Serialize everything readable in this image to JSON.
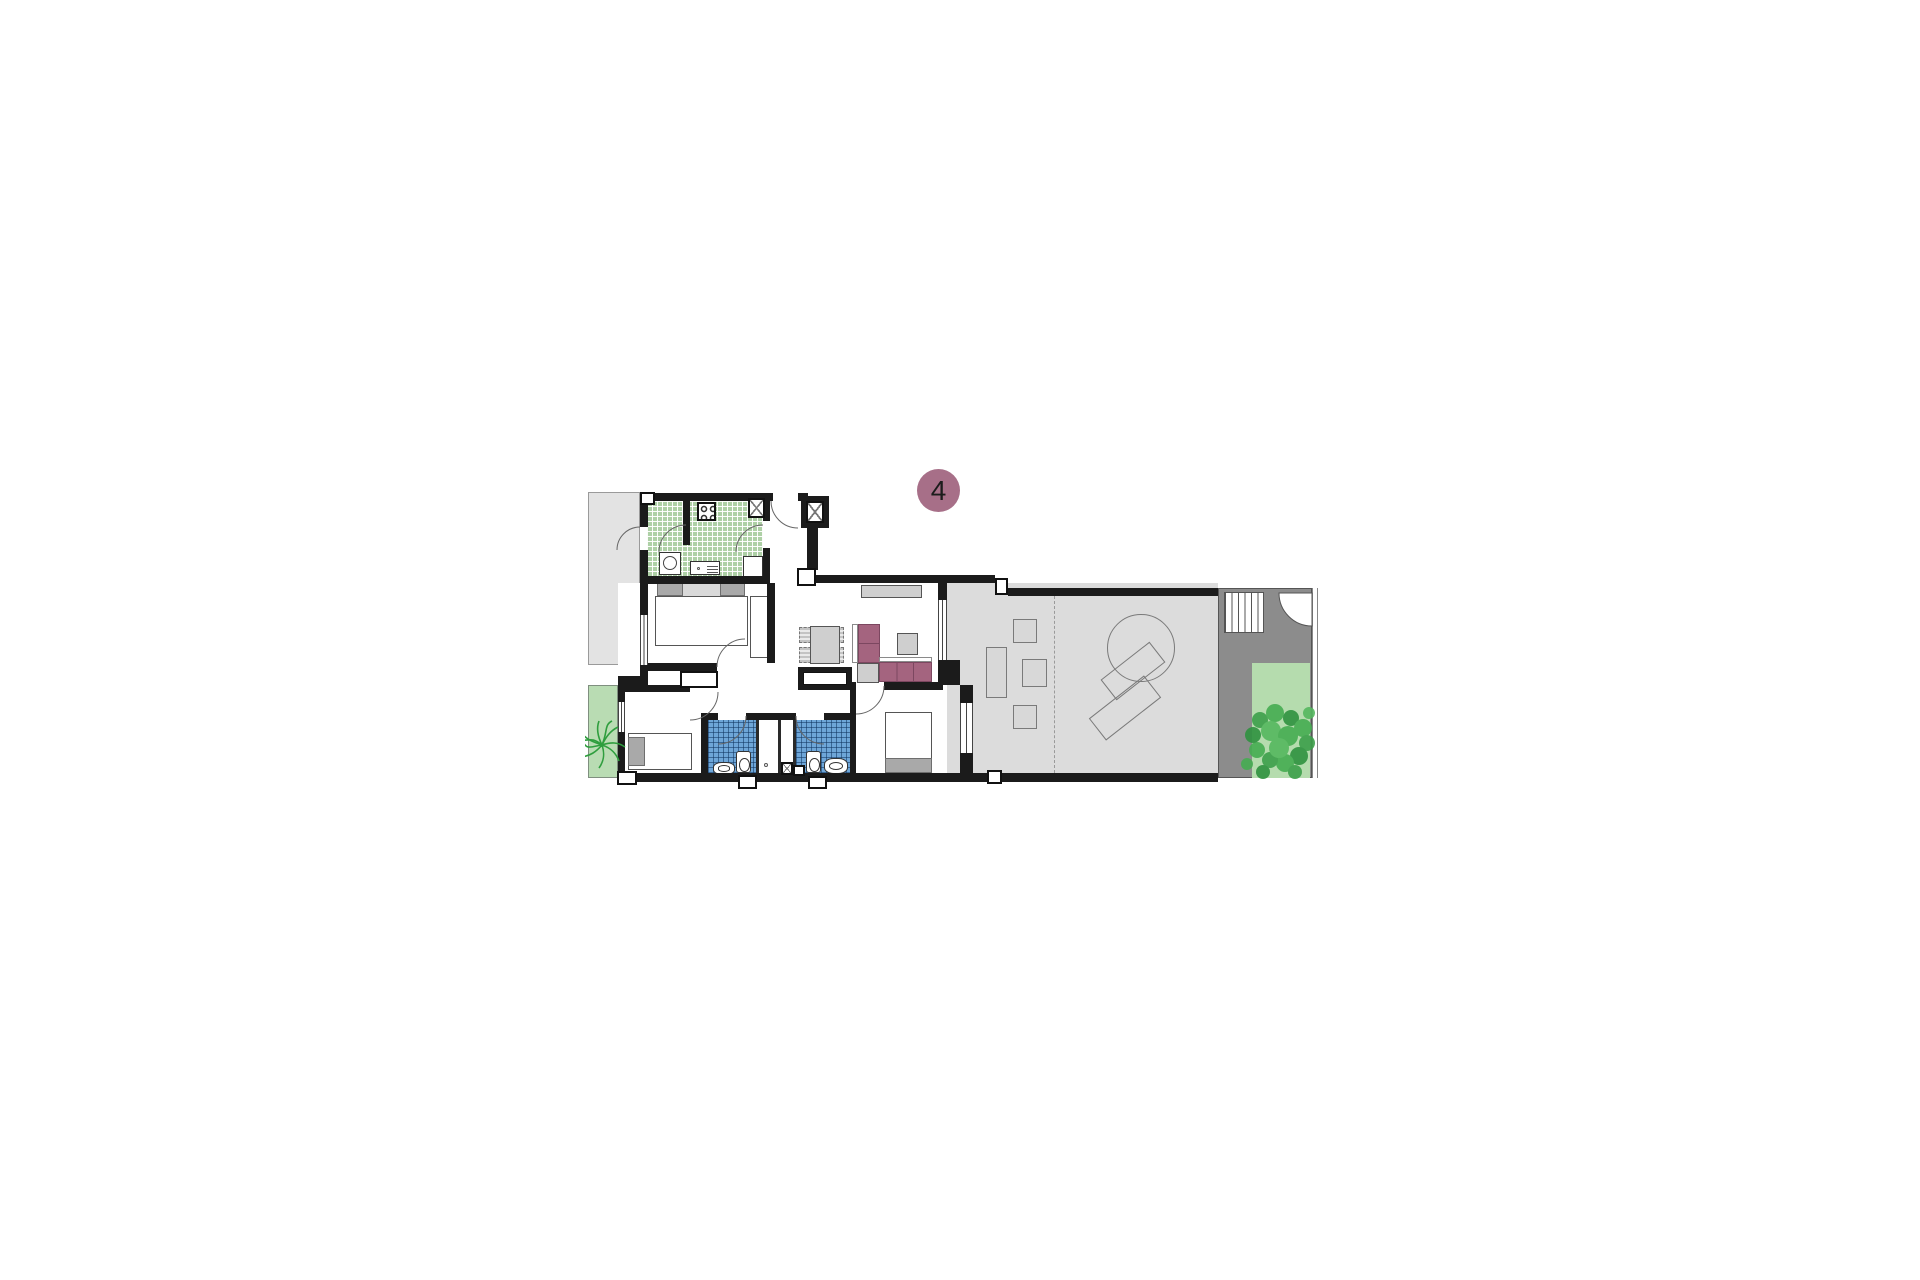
{
  "badge": {
    "label": "4"
  },
  "colors": {
    "badge": "#a76f88",
    "wall": "#1b1b1b",
    "side_terrace": "#e3e3e3",
    "terrace_floor": "#dcdcdc",
    "yard": "#8c8c8c",
    "garden": "#b5dcae",
    "patio": "#b9dcb3",
    "kitchen_tile": "#aed0a6",
    "bath_tile": "#6ea6d8",
    "sofa": "#a4647f",
    "furniture_gray": "#cfcfcf",
    "plant_green": "#3da04b"
  }
}
